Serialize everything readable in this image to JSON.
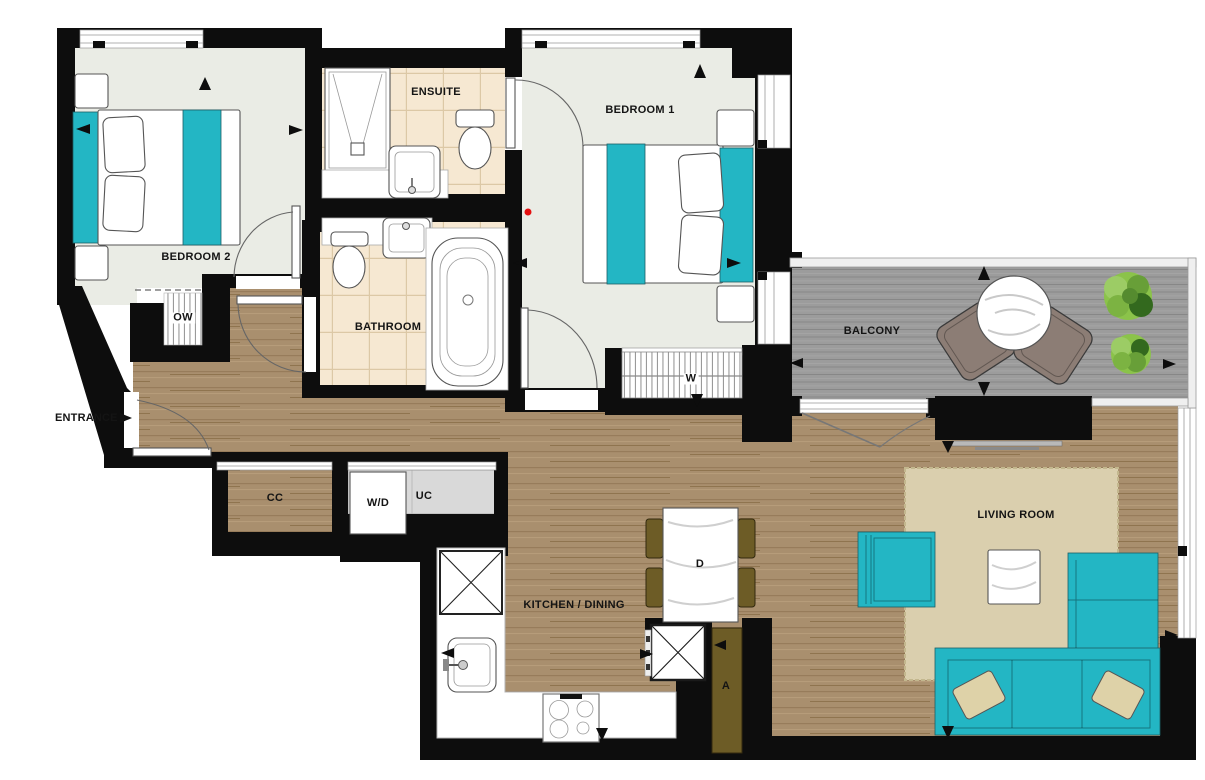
{
  "floorplan": {
    "rooms": {
      "bedroom1": "BEDROOM 1",
      "bedroom2": "BEDROOM 2",
      "ensuite": "ENSUITE",
      "bathroom": "BATHROOM",
      "balcony": "BALCONY",
      "living_room": "LIVING ROOM",
      "kitchen_dining": "KITCHEN / DINING"
    },
    "annotations": {
      "entrance": "ENTRANCE",
      "open_wardrobe": "OW",
      "wardrobe": "W",
      "coats_cupboard": "CC",
      "washer_dryer": "W/D",
      "utility_cupboard": "UC",
      "dining_table": "D",
      "airing_cupboard": "A"
    },
    "colors": {
      "wall": "#0d0d0d",
      "accent_teal": "#23b6c4",
      "wood_floor": "#a98f6e",
      "bedroom_floor": "#eaece5",
      "tile_floor": "#f6e8d2",
      "balcony_deck": "#9c9c9c",
      "rug": "#dacfae",
      "chair_olive": "#6d5c26",
      "balcony_chair": "#8c7d75",
      "plant_green": "#8bc34a",
      "marker_red": "#e51010"
    }
  }
}
